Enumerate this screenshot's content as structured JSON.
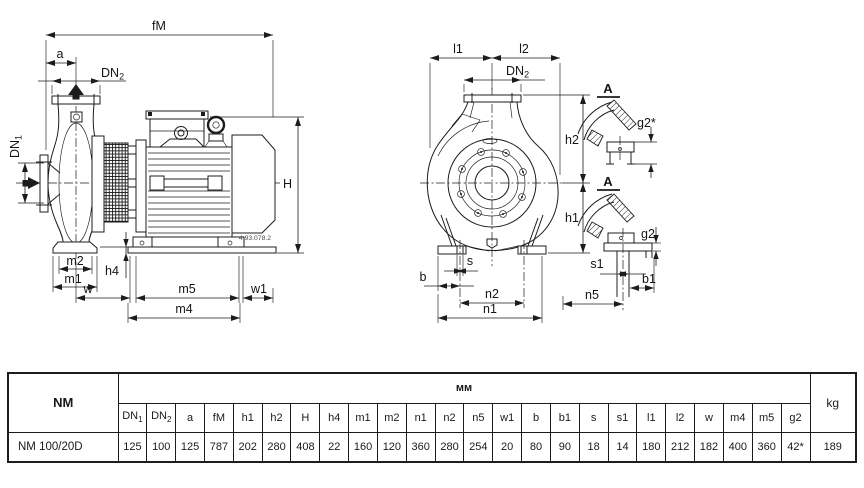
{
  "drawing": {
    "side_view": {
      "labels": {
        "fm": "fM",
        "a": "a",
        "dn1_base": "DN",
        "dn1_sub": "1",
        "dn2_base": "DN",
        "dn2_sub": "2",
        "m2": "m2",
        "m1": "m1",
        "h4": "h4",
        "w": "w",
        "m5": "m5",
        "w1": "w1",
        "m4": "m4",
        "h": "H"
      },
      "ref_code": "4.93.078.2"
    },
    "front_view": {
      "labels": {
        "l1": "l1",
        "l2": "l2",
        "dn2_base": "DN",
        "dn2_sub": "2",
        "h2": "h2",
        "h1": "h1",
        "b": "b",
        "s": "s",
        "n2": "n2",
        "n1": "n1"
      }
    },
    "sections": {
      "top_title": "A",
      "bottom_title": "A",
      "g2_star": "g2*",
      "g2": "g2",
      "s1": "s1",
      "b1": "b1",
      "n5": "n5"
    }
  },
  "table": {
    "series_label": "NM",
    "unit_header": "мм",
    "weight_header": "kg",
    "columns": [
      {
        "base": "DN",
        "sub": "1"
      },
      {
        "base": "DN",
        "sub": "2"
      },
      {
        "base": "a",
        "sub": ""
      },
      {
        "base": "fM",
        "sub": ""
      },
      {
        "base": "h1",
        "sub": ""
      },
      {
        "base": "h2",
        "sub": ""
      },
      {
        "base": "H",
        "sub": ""
      },
      {
        "base": "h4",
        "sub": ""
      },
      {
        "base": "m1",
        "sub": ""
      },
      {
        "base": "m2",
        "sub": ""
      },
      {
        "base": "n1",
        "sub": ""
      },
      {
        "base": "n2",
        "sub": ""
      },
      {
        "base": "n5",
        "sub": ""
      },
      {
        "base": "w1",
        "sub": ""
      },
      {
        "base": "b",
        "sub": ""
      },
      {
        "base": "b1",
        "sub": ""
      },
      {
        "base": "s",
        "sub": ""
      },
      {
        "base": "s1",
        "sub": ""
      },
      {
        "base": "l1",
        "sub": ""
      },
      {
        "base": "l2",
        "sub": ""
      },
      {
        "base": "w",
        "sub": ""
      },
      {
        "base": "m4",
        "sub": ""
      },
      {
        "base": "m5",
        "sub": ""
      },
      {
        "base": "g2",
        "sub": ""
      }
    ],
    "rows": [
      {
        "model": "NM 100/20D",
        "values": [
          "125",
          "100",
          "125",
          "787",
          "202",
          "280",
          "408",
          "22",
          "160",
          "120",
          "360",
          "280",
          "254",
          "20",
          "80",
          "90",
          "18",
          "14",
          "180",
          "212",
          "182",
          "400",
          "360",
          "42*"
        ],
        "weight": "189"
      }
    ]
  },
  "colors": {
    "line": "#1c1c1c",
    "background": "#ffffff"
  }
}
